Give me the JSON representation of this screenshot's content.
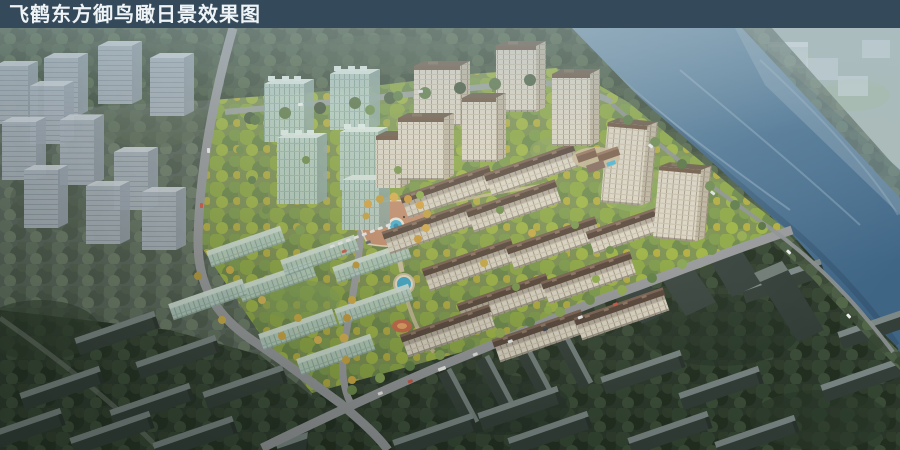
{
  "title_bar": {
    "title": "飞鹤东方御鸟瞰日景效果图"
  },
  "palette": {
    "title_bar_bg": "#344a5b",
    "title_text": "#eef3f6",
    "river_water": "#4d7595",
    "bright_foliage": "#8ca743",
    "autumn_tree": "#d3b049",
    "building_facade": "#dcd5c5",
    "building_roof_brown": "#5e4b3e",
    "glass_massing": "#b7cfc6",
    "ghost_massing": "#a9b3bd",
    "context_foliage_dark": "#2c392c",
    "fountain_water": "#49b5d5",
    "road_gray": "#96989b"
  }
}
